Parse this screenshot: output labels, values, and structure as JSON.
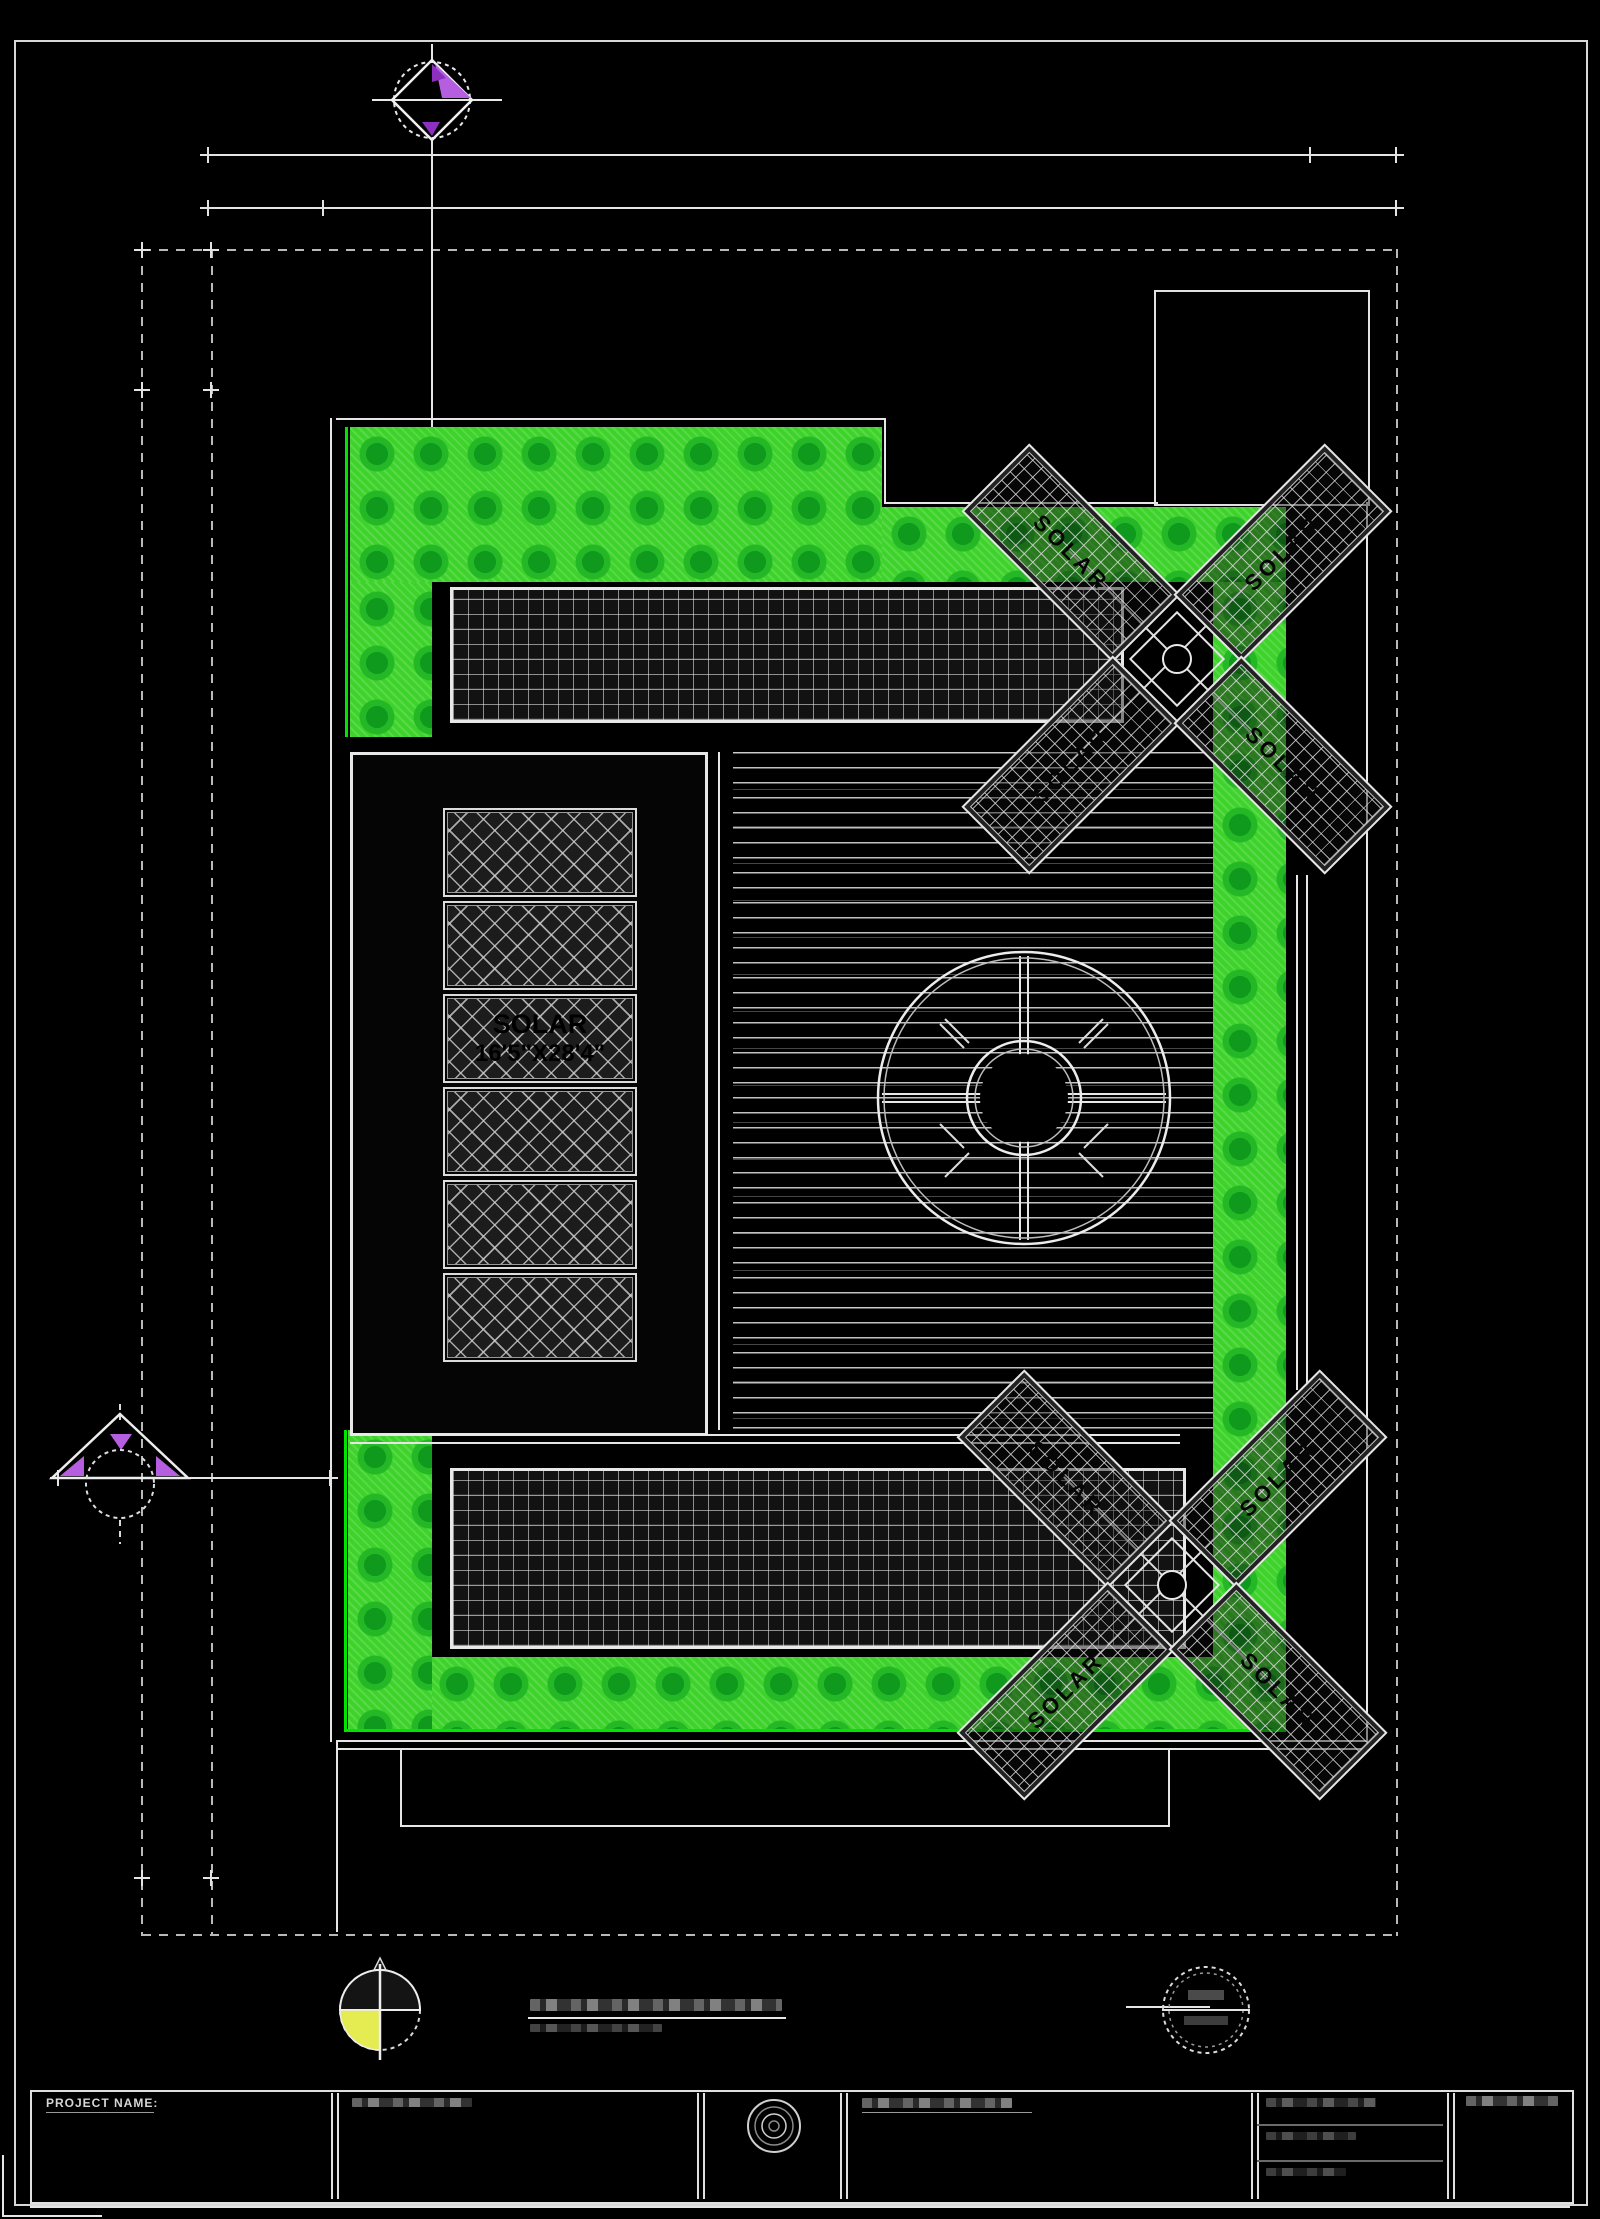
{
  "document": {
    "kind": "architectural roof plan CAD sheet"
  },
  "plan": {
    "panel_label_line1": "SOLAR",
    "panel_label_line2": "16'5\"X28'4\"",
    "blade_label": "SOLAR"
  },
  "title_block": {
    "project_name_label": "PROJECT NAME:"
  },
  "colors": {
    "background": "#000000",
    "line_white": "#e6e6e6",
    "grass_green": "#3ed32b",
    "grass_dot_green": "#109a1d",
    "grass_edge_green": "#00e400",
    "accent_purple": "#b55fe0",
    "compass_yellow": "#e4ec52"
  }
}
